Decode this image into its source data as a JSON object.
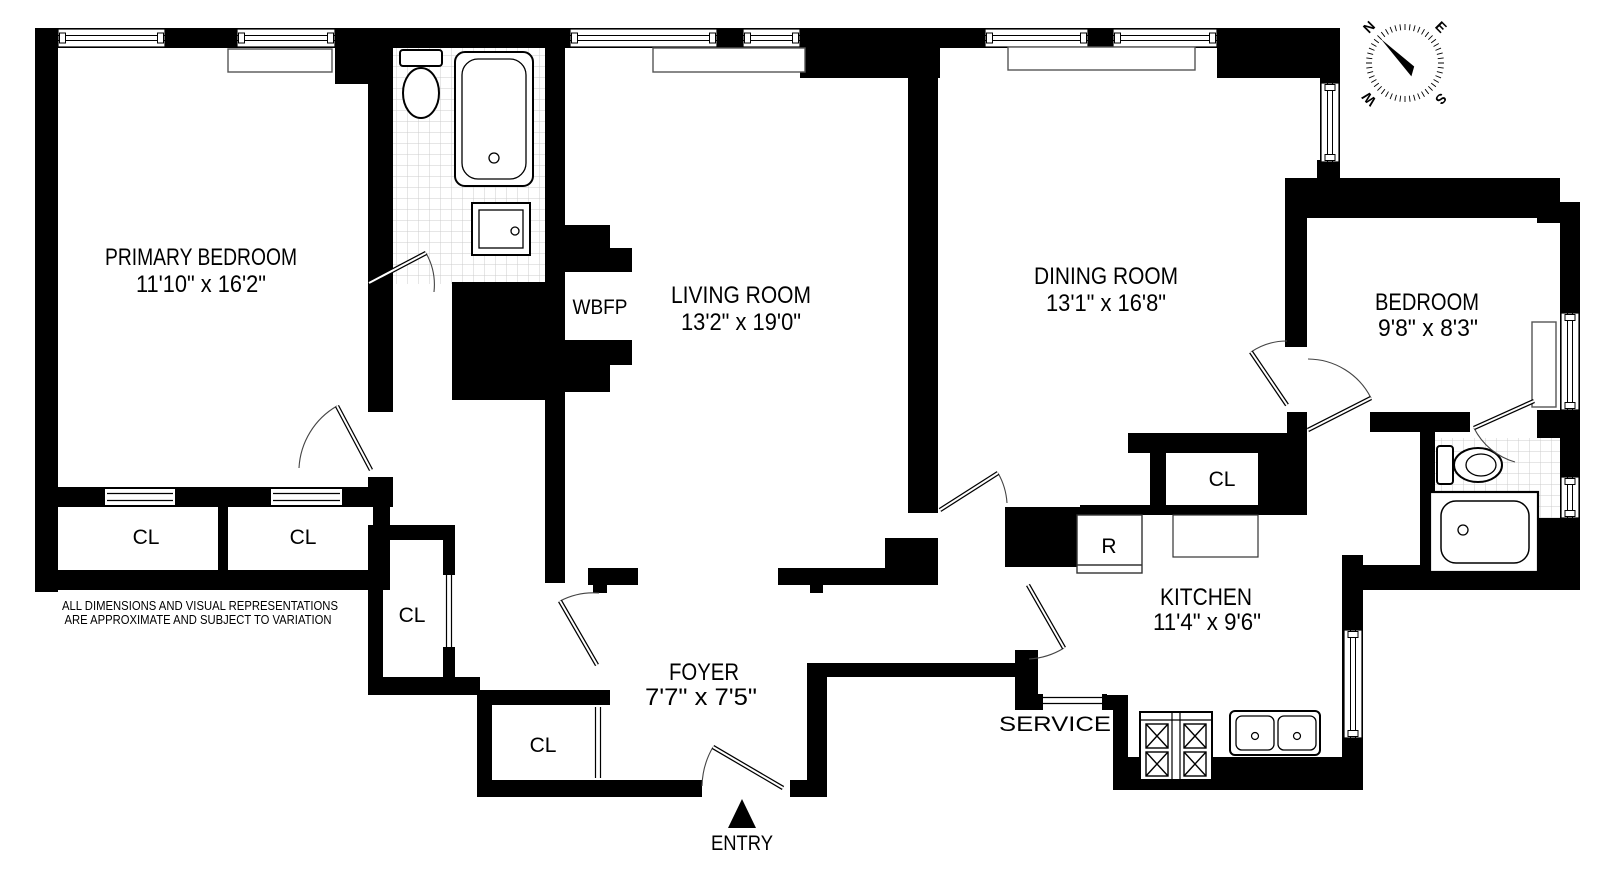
{
  "plan": {
    "rooms": {
      "primary_bedroom": {
        "name": "PRIMARY BEDROOM",
        "dims": "11'10\" x 16'2\""
      },
      "living_room": {
        "name": "LIVING ROOM",
        "dims": "13'2\" x 19'0\""
      },
      "dining_room": {
        "name": "DINING ROOM",
        "dims": "13'1\" x 16'8\""
      },
      "bedroom": {
        "name": "BEDROOM",
        "dims": "9'8\" x 8'3\""
      },
      "kitchen": {
        "name": "KITCHEN",
        "dims": "11'4\" x 9'6\""
      },
      "foyer": {
        "name": "FOYER",
        "dims": "7'7\" x 7'5\""
      }
    },
    "labels": {
      "wbfp": "WBFP",
      "refrigerator": "R",
      "service": "SERVICE",
      "entry": "ENTRY"
    },
    "closets": [
      "CL",
      "CL",
      "CL",
      "CL",
      "CL"
    ],
    "compass": {
      "n": "N",
      "e": "E",
      "s": "S",
      "w": "W"
    },
    "disclaimer": {
      "line1": "ALL DIMENSIONS AND VISUAL REPRESENTATIONS",
      "line2": "ARE APPROXIMATE AND SUBJECT TO VARIATION"
    },
    "colors": {
      "wall": "#000000",
      "background": "#ffffff",
      "tile_line": "#cccccc"
    }
  }
}
